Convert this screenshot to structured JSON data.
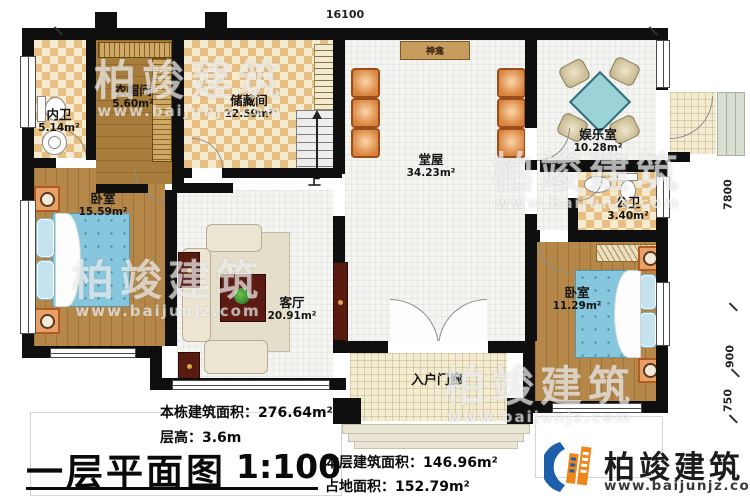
{
  "plan": {
    "rooms": {
      "neiwei": {
        "name": "内卫",
        "area": "5.14m²"
      },
      "yimaojian": {
        "name": "衣帽间",
        "area": "5.60m²"
      },
      "chucangjian": {
        "name": "储藏间",
        "area": "12.59m²"
      },
      "tangwu": {
        "name": "堂屋",
        "area": "34.23m²"
      },
      "yuleshi": {
        "name": "娱乐室",
        "area": "10.28m²"
      },
      "gongwei": {
        "name": "公卫",
        "area": "3.40m²"
      },
      "bedroom_left": {
        "name": "卧室",
        "area": "15.59m²"
      },
      "bedroom_right": {
        "name": "卧室",
        "area": "11.29m²"
      },
      "keting": {
        "name": "客厅",
        "area": "20.91m²"
      },
      "porch": {
        "name": "入户门廊"
      }
    },
    "labels": {
      "shrine": "神龛",
      "stairs_up": "上"
    },
    "dimensions": {
      "top": "16100",
      "right_upper": "7800",
      "right_mid": "900",
      "right_lower": "750"
    }
  },
  "footer": {
    "building_area": "本栋建筑面积：276.64m²",
    "floor_height": "层高：3.6m",
    "title": "一层平面图",
    "scale": "1:100",
    "floor_area": "本层建筑面积：146.96m²",
    "footprint_area": "占地面积：152.79m²"
  },
  "brand": {
    "name": "柏竣建筑",
    "website": "www.baijunjz.com"
  },
  "watermark": {
    "text": "柏竣建筑",
    "url": "www.baijunjz.com"
  },
  "colors": {
    "wall": "#0f0f0f",
    "checker_floor": "#e7bf82",
    "wood_floor": "#b5884a",
    "bed_blue": "#87c7dd",
    "game_table_teal": "#9cd3d8",
    "hall_chair_orange": "#d9823d",
    "brand_blue": "#1d5fa8",
    "brand_orange": "#f08519"
  }
}
